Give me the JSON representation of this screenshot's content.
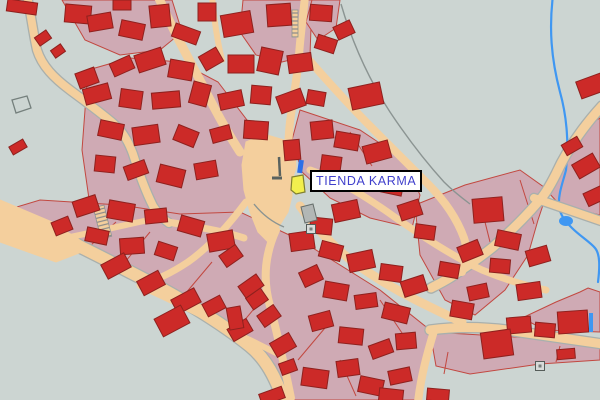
{
  "label": {
    "text": "TIENDA KARMA",
    "x": 310,
    "y": 170,
    "w": 95,
    "h": 22
  },
  "colors": {
    "background": "#ccd5d2",
    "street": "#f4cf9d",
    "street_edge": "#a9b0ad",
    "parcel": "#cfaab4",
    "parcel_stroke": "#c24840",
    "building": "#cc2a28",
    "building_stroke": "#8e211e",
    "river": "#3f97f2",
    "selection": "#f2ef4e",
    "selection_stroke": "#80802f",
    "marker": "#2c6fe8",
    "label_text": "#4040cc",
    "label_bg": "#ffffff",
    "label_border": "#000000",
    "gray": "#b2b7b5",
    "gray_stroke": "#666e6b",
    "boundary": "#8b9492",
    "wall": "#59625f",
    "stair_rung": "#8a8a8a",
    "outline_plot_stroke": "#75807d"
  },
  "map": {
    "parcels": [
      {
        "pts": "62,0 172,0 182,32 160,50 120,55 85,40"
      },
      {
        "pts": "243,0 312,0 310,55 282,62 256,55 240,32"
      },
      {
        "pts": "312,0 340,0 336,28 318,40 306,22"
      },
      {
        "pts": "88,70 130,58 180,62 218,82 250,124 258,164 246,204 206,234 160,254 114,246 90,206 82,150"
      },
      {
        "pts": "300,110 360,130 405,160 420,195 412,228 370,218 330,198 302,172 292,140"
      },
      {
        "pts": "0,212 70,240 140,276 205,310 252,348 282,400 420,400 430,330 380,290 300,240 240,212 180,214 120,205 40,200"
      },
      {
        "pts": "415,205 465,185 520,170 548,190 538,220 528,255 505,290 475,315 445,300 420,255"
      },
      {
        "pts": "600,118 600,215 560,205 548,192 560,168 575,142 588,125"
      },
      {
        "pts": "430,332 600,342 600,360 540,364 470,374 436,366"
      },
      {
        "pts": "588,288 600,292 600,332 545,330 522,318 556,302 580,292"
      }
    ],
    "parcel_lines": [
      "M 120,268 L 150,232",
      "M 180,300 L 212,262",
      "M 238,328 L 268,292",
      "M 298,360 L 330,322",
      "M 90,246 L 116,222",
      "M 480,202 L 492,250",
      "M 520,180 L 534,224",
      "M 350,132 L 372,166",
      "M 340,360 L 356,396",
      "M 380,300 L 404,336",
      "M 448,352 L 444,374",
      "M 560,346 L 556,362"
    ],
    "river": {
      "d": "M 553,-5 C 549,28 551,58 560,92 C 567,117 569,145 566,170 C 563,182 558,194 559,206 C 560,215 565,221 572,228 C 580,236 590,242 595,248 C 600,254 600,266 598,282",
      "w": 2.2
    },
    "pond": {
      "cx": 566,
      "cy": 221,
      "rx": 7,
      "ry": 5
    },
    "blue_strip": {
      "x": 589,
      "y": 313,
      "w": 4,
      "h": 19
    },
    "streets": [
      {
        "d": "M 27,-4 C 31,14 33,32 37,50 C 42,66 54,78 70,90 C 86,102 100,112 114,124 C 122,131 128,140 133,154 C 138,170 145,190 153,206 C 158,214 163,219 169,223",
        "w": 8,
        "e": true
      },
      {
        "d": "M 158,-4 C 171,26 186,54 202,84 C 214,108 227,132 240,152",
        "w": 9,
        "e": false
      },
      {
        "d": "M 212,-4 C 214,18 217,40 222,60",
        "w": 6,
        "e": false
      },
      {
        "d": "M 305,-4 C 303,18 300,38 299,56 C 297,78 293,100 290,122 C 288,140 288,152 289,162",
        "w": 8,
        "e": false
      },
      {
        "d": "M 309,60 C 330,84 352,108 374,130 C 392,148 410,166 428,184 C 442,198 456,216 464,238 C 468,250 466,262 462,272",
        "w": 8,
        "e": false
      },
      {
        "d": "M 602,106 C 582,128 566,152 556,174 C 549,188 544,196 538,202 C 526,216 510,232 493,247 C 477,260 463,269 451,277 C 443,282 437,285 431,288",
        "w": 9,
        "e": true
      },
      {
        "d": "M 534,198 L 604,222",
        "w": 8,
        "e": true
      },
      {
        "d": "M 430,330 C 460,326 490,327 520,332 C 548,336 575,340 603,344",
        "w": 9,
        "e": true
      },
      {
        "d": "M -6,206 C 30,222 80,246 130,272 C 175,295 218,320 250,346 C 266,359 276,378 284,402",
        "w": 12,
        "e": true
      },
      {
        "d": "M 246,202 C 228,226 208,248 188,262 C 170,274 154,281 140,285",
        "w": 7,
        "e": false
      },
      {
        "d": "M 276,230 C 266,252 262,278 270,306 C 277,332 284,364 291,398",
        "w": 8,
        "e": false
      },
      {
        "d": "M 300,206 C 316,228 334,248 356,264 C 376,278 396,290 416,300 C 434,309 450,317 462,322",
        "w": 9,
        "e": false
      },
      {
        "d": "M 310,170 C 340,180 368,198 396,218 C 422,236 452,256 482,270 C 504,279 526,286 546,290",
        "w": 7,
        "e": false
      },
      {
        "d": "M 56,240 C 95,232 130,224 162,217",
        "w": 6,
        "e": false
      },
      {
        "d": "M 140,286 C 175,302 212,320 246,338 C 260,345 272,351 282,356",
        "w": 6,
        "e": false
      },
      {
        "d": "M 434,331 C 427,354 421,376 418,402",
        "w": 8,
        "e": false
      },
      {
        "d": "M 168,222 C 196,227 220,230 244,238",
        "w": 7,
        "e": false
      }
    ],
    "street_areas": [
      {
        "pts": "246,142 264,134 284,140 295,152 296,168 292,180 292,196 288,212 278,228 268,242 258,232 250,212 244,190 242,165"
      },
      {
        "pts": "0,200 52,222 92,248 56,262 0,242"
      }
    ],
    "stairs": [
      {
        "x": 292,
        "y": 10,
        "w": 6,
        "h": 27,
        "rot": 0
      },
      {
        "x": 97,
        "y": 206,
        "w": 11,
        "h": 32,
        "rot": -14
      }
    ],
    "boundary_lines": [
      "M 341,4 C 352,42 368,78 390,112 C 406,136 424,160 444,182 C 452,190 462,198 470,204",
      "M 254,204 C 262,214 272,222 284,227"
    ],
    "walls": [
      {
        "d": "M 279,157 L 280,176",
        "w": 2.5
      },
      {
        "d": "M 272,178 L 282,178",
        "w": 3
      }
    ],
    "buildings": [
      [
        22,
        7,
        30,
        12,
        8
      ],
      [
        122,
        5,
        18,
        10,
        0
      ],
      [
        43,
        38,
        14,
        10,
        -35
      ],
      [
        58,
        51,
        12,
        9,
        -35
      ],
      [
        18,
        147,
        16,
        9,
        -30
      ],
      [
        87,
        78,
        20,
        16,
        -20
      ],
      [
        78,
        14,
        26,
        18,
        5
      ],
      [
        100,
        22,
        24,
        16,
        -10
      ],
      [
        132,
        30,
        24,
        16,
        12
      ],
      [
        160,
        16,
        20,
        22,
        -6
      ],
      [
        186,
        34,
        26,
        14,
        20
      ],
      [
        207,
        12,
        18,
        18,
        0
      ],
      [
        237,
        24,
        30,
        22,
        -10
      ],
      [
        279,
        15,
        24,
        22,
        -4
      ],
      [
        321,
        13,
        22,
        16,
        4
      ],
      [
        344,
        30,
        18,
        14,
        -25
      ],
      [
        122,
        66,
        22,
        14,
        -24
      ],
      [
        150,
        60,
        28,
        18,
        -18
      ],
      [
        181,
        70,
        24,
        18,
        10
      ],
      [
        211,
        59,
        20,
        16,
        -30
      ],
      [
        241,
        64,
        26,
        18,
        0
      ],
      [
        270,
        61,
        22,
        24,
        12
      ],
      [
        300,
        63,
        24,
        18,
        -8
      ],
      [
        326,
        44,
        20,
        14,
        18
      ],
      [
        97,
        94,
        26,
        16,
        -15
      ],
      [
        131,
        99,
        22,
        18,
        8
      ],
      [
        166,
        100,
        28,
        16,
        -5
      ],
      [
        200,
        94,
        18,
        22,
        15
      ],
      [
        231,
        100,
        24,
        16,
        -12
      ],
      [
        261,
        95,
        20,
        18,
        5
      ],
      [
        291,
        101,
        26,
        18,
        -20
      ],
      [
        316,
        98,
        18,
        14,
        10
      ],
      [
        366,
        96,
        32,
        22,
        -12
      ],
      [
        111,
        130,
        24,
        16,
        12
      ],
      [
        146,
        135,
        26,
        18,
        -8
      ],
      [
        186,
        136,
        22,
        16,
        22
      ],
      [
        221,
        134,
        20,
        14,
        -15
      ],
      [
        256,
        130,
        24,
        18,
        4
      ],
      [
        105,
        164,
        20,
        16,
        6
      ],
      [
        136,
        170,
        22,
        14,
        -20
      ],
      [
        171,
        176,
        26,
        18,
        14
      ],
      [
        206,
        170,
        22,
        16,
        -10
      ],
      [
        292,
        150,
        16,
        20,
        -5
      ],
      [
        322,
        130,
        22,
        18,
        -6
      ],
      [
        347,
        141,
        24,
        16,
        10
      ],
      [
        377,
        152,
        26,
        18,
        -15
      ],
      [
        331,
        164,
        20,
        16,
        8
      ],
      [
        361,
        181,
        24,
        18,
        -5
      ],
      [
        392,
        186,
        22,
        16,
        12
      ],
      [
        346,
        211,
        26,
        18,
        -12
      ],
      [
        321,
        226,
        22,
        16,
        6
      ],
      [
        410,
        210,
        22,
        16,
        -18
      ],
      [
        425,
        232,
        20,
        14,
        8
      ],
      [
        488,
        210,
        30,
        24,
        -5
      ],
      [
        508,
        240,
        24,
        16,
        12
      ],
      [
        538,
        256,
        22,
        16,
        -16
      ],
      [
        500,
        266,
        20,
        14,
        5
      ],
      [
        470,
        251,
        22,
        16,
        -22
      ],
      [
        449,
        270,
        20,
        14,
        10
      ],
      [
        529,
        291,
        24,
        16,
        -8
      ],
      [
        572,
        146,
        18,
        12,
        -30
      ],
      [
        586,
        166,
        24,
        16,
        -30
      ],
      [
        595,
        196,
        20,
        14,
        -25
      ],
      [
        591,
        86,
        26,
        18,
        -20
      ],
      [
        86,
        206,
        24,
        16,
        -18
      ],
      [
        121,
        211,
        26,
        18,
        10
      ],
      [
        156,
        216,
        22,
        14,
        -6
      ],
      [
        191,
        226,
        24,
        16,
        16
      ],
      [
        221,
        241,
        26,
        18,
        -10
      ],
      [
        97,
        236,
        22,
        14,
        12
      ],
      [
        62,
        226,
        18,
        14,
        -22
      ],
      [
        132,
        246,
        24,
        16,
        -4
      ],
      [
        166,
        251,
        20,
        14,
        18
      ],
      [
        116,
        266,
        26,
        16,
        -28
      ],
      [
        151,
        283,
        24,
        16,
        -28
      ],
      [
        186,
        301,
        26,
        16,
        -28
      ],
      [
        214,
        306,
        20,
        14,
        -28
      ],
      [
        172,
        321,
        30,
        20,
        -28
      ],
      [
        240,
        330,
        22,
        14,
        -30
      ],
      [
        257,
        299,
        18,
        14,
        -35
      ],
      [
        235,
        318,
        14,
        22,
        -10
      ],
      [
        283,
        345,
        22,
        16,
        -30
      ],
      [
        231,
        256,
        20,
        14,
        -35
      ],
      [
        251,
        286,
        22,
        14,
        -35
      ],
      [
        269,
        316,
        20,
        14,
        -35
      ],
      [
        288,
        367,
        16,
        12,
        -20
      ],
      [
        302,
        241,
        24,
        18,
        -8
      ],
      [
        331,
        251,
        22,
        16,
        15
      ],
      [
        361,
        261,
        26,
        18,
        -12
      ],
      [
        391,
        273,
        22,
        16,
        8
      ],
      [
        414,
        286,
        24,
        16,
        -18
      ],
      [
        311,
        276,
        20,
        16,
        -25
      ],
      [
        336,
        291,
        24,
        16,
        10
      ],
      [
        366,
        301,
        22,
        14,
        -8
      ],
      [
        396,
        313,
        26,
        16,
        14
      ],
      [
        321,
        321,
        22,
        16,
        -15
      ],
      [
        351,
        336,
        24,
        16,
        6
      ],
      [
        381,
        349,
        22,
        14,
        -20
      ],
      [
        315,
        378,
        26,
        18,
        8
      ],
      [
        348,
        368,
        22,
        16,
        -8
      ],
      [
        371,
        386,
        24,
        16,
        12
      ],
      [
        272,
        396,
        24,
        12,
        -20
      ],
      [
        406,
        341,
        20,
        16,
        -5
      ],
      [
        400,
        376,
        22,
        14,
        -12
      ],
      [
        391,
        396,
        24,
        14,
        6
      ],
      [
        519,
        325,
        24,
        16,
        -5
      ],
      [
        545,
        330,
        20,
        14,
        5
      ],
      [
        573,
        322,
        30,
        22,
        -4
      ],
      [
        497,
        344,
        30,
        26,
        -8
      ],
      [
        566,
        354,
        18,
        10,
        -5
      ],
      [
        438,
        395,
        22,
        12,
        5
      ],
      [
        462,
        310,
        22,
        16,
        10
      ],
      [
        478,
        292,
        20,
        14,
        -12
      ]
    ],
    "outlined_plots": [
      {
        "pts": "12,100 27,96 31,108 16,113"
      }
    ],
    "gray_shapes": [
      {
        "pts": "301,207 313,204 317,220 305,223"
      }
    ],
    "symbols": [
      {
        "x": 311,
        "y": 229,
        "s": 9
      },
      {
        "x": 540,
        "y": 366,
        "s": 9
      }
    ],
    "selection": {
      "pts": "292,177 303,175 305,192 296,194 291,190"
    },
    "marker": {
      "x": 298,
      "y": 160,
      "w": 5,
      "h": 13,
      "rot": 8
    }
  }
}
